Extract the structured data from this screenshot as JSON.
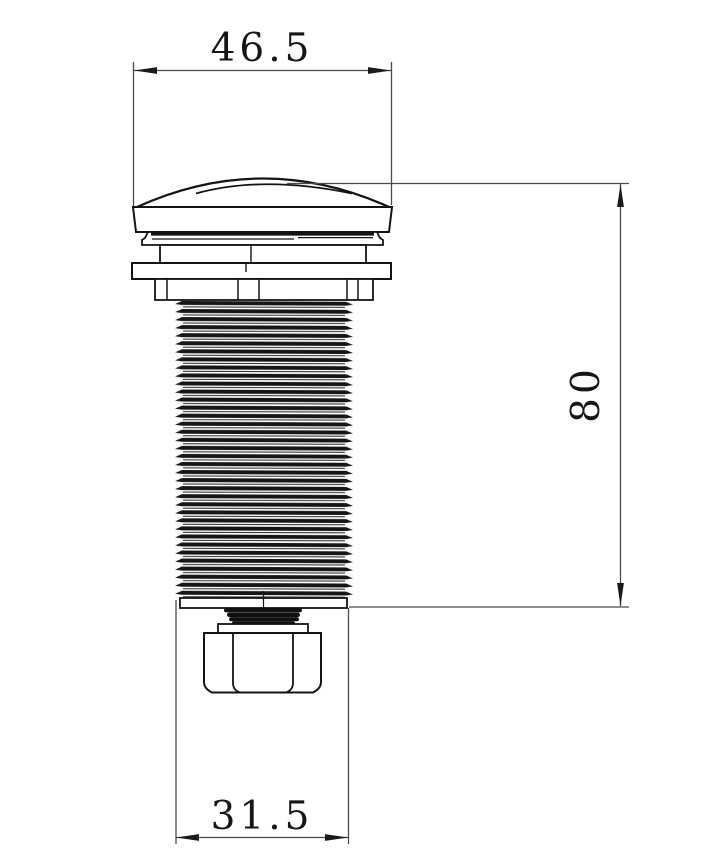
{
  "colors": {
    "background": "#ffffff",
    "outline": "#141414",
    "dimension_line": "#4a4a4a",
    "text": "#161616"
  },
  "drawing": {
    "kind": "technical-dimension-drawing",
    "view": "side elevation of threaded dome-cap fitting with hex nut"
  },
  "dimensions": {
    "top_width": "46.5",
    "height": "80",
    "bottom_width": "31.5"
  }
}
